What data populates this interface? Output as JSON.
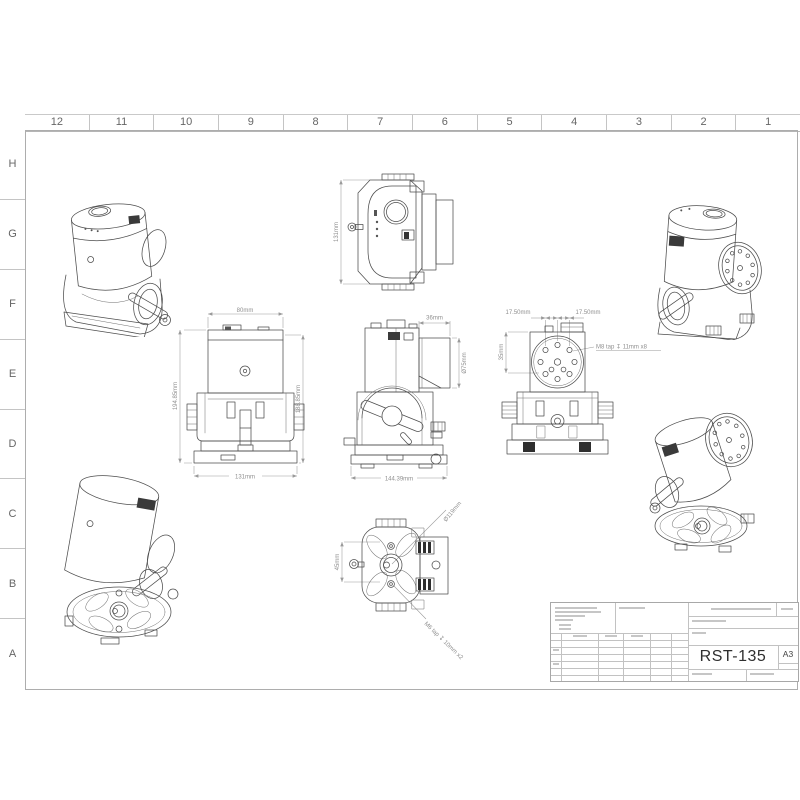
{
  "sheet": {
    "columns": [
      "12",
      "11",
      "10",
      "9",
      "8",
      "7",
      "6",
      "5",
      "4",
      "3",
      "2",
      "1"
    ],
    "rows": [
      "H",
      "G",
      "F",
      "E",
      "D",
      "C",
      "B",
      "A"
    ]
  },
  "title_block": {
    "drawing_number": "RST-135",
    "paper_size": "A3"
  },
  "views": {
    "top": {
      "height": "131mm"
    },
    "front": {
      "top_width": "80mm",
      "left_height": "194.85mm",
      "right_height": "188.85mm",
      "bottom_width": "131mm"
    },
    "side": {
      "top_width": "36mm",
      "right_diameter": "Ø75mm",
      "bottom_width": "144.39mm"
    },
    "back": {
      "offset_left": "17.50mm",
      "offset_right": "17.50mm",
      "left_height": "35mm",
      "tap_note": "M8 tap ↧ 11mm x8"
    },
    "bottom": {
      "left_height": "45mm",
      "diameter_note": "Ø119mm",
      "tap_note": "M6 tap ↧ 10mm x2"
    }
  }
}
